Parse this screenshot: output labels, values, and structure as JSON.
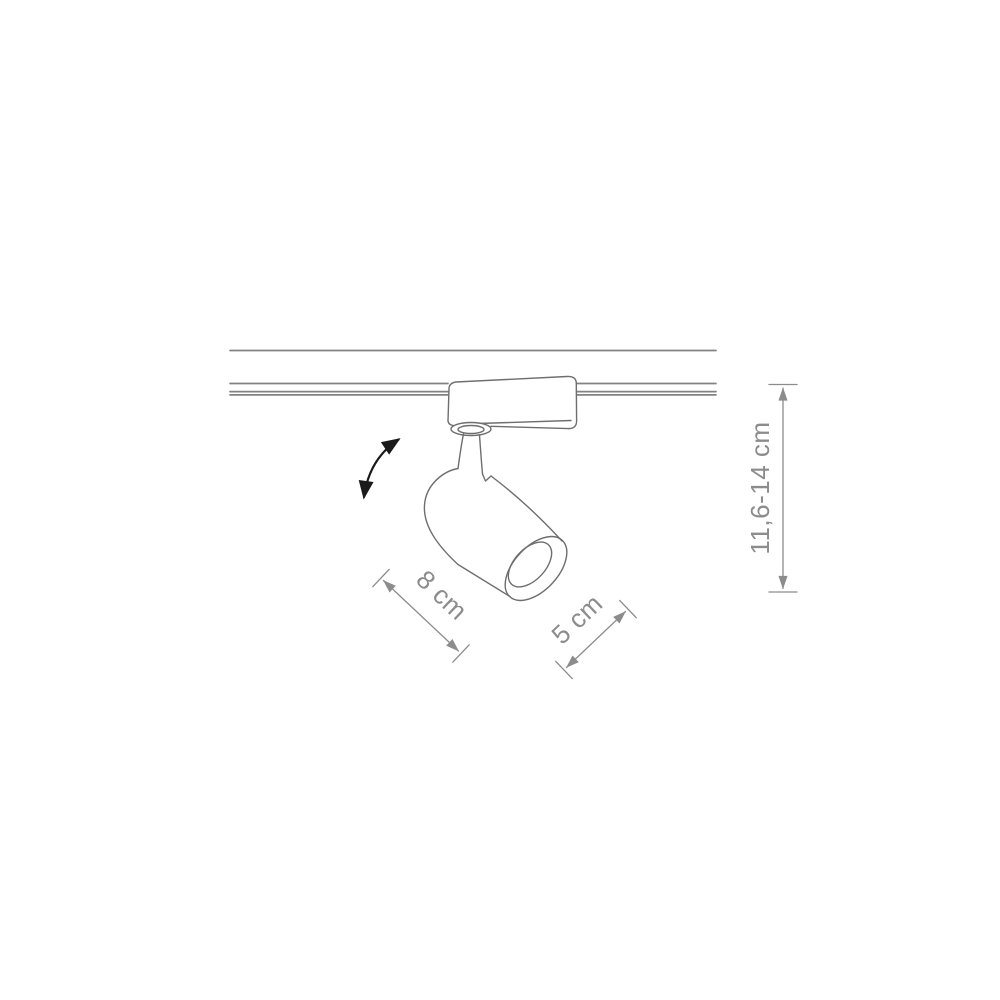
{
  "figure": {
    "title": "Track-mounted spotlight dimensional drawing",
    "labels": {
      "length": "8 cm",
      "diameter": "5 cm",
      "height": "11,6-14 cm"
    },
    "colors": {
      "background": "#ffffff",
      "track_line": "#828282",
      "fixture_line": "#6e6e6e",
      "dimension": "#8c8c8c",
      "arrow": "#1a1a1a"
    },
    "icons": {
      "tilt": "curved-double-arrow-icon"
    }
  }
}
